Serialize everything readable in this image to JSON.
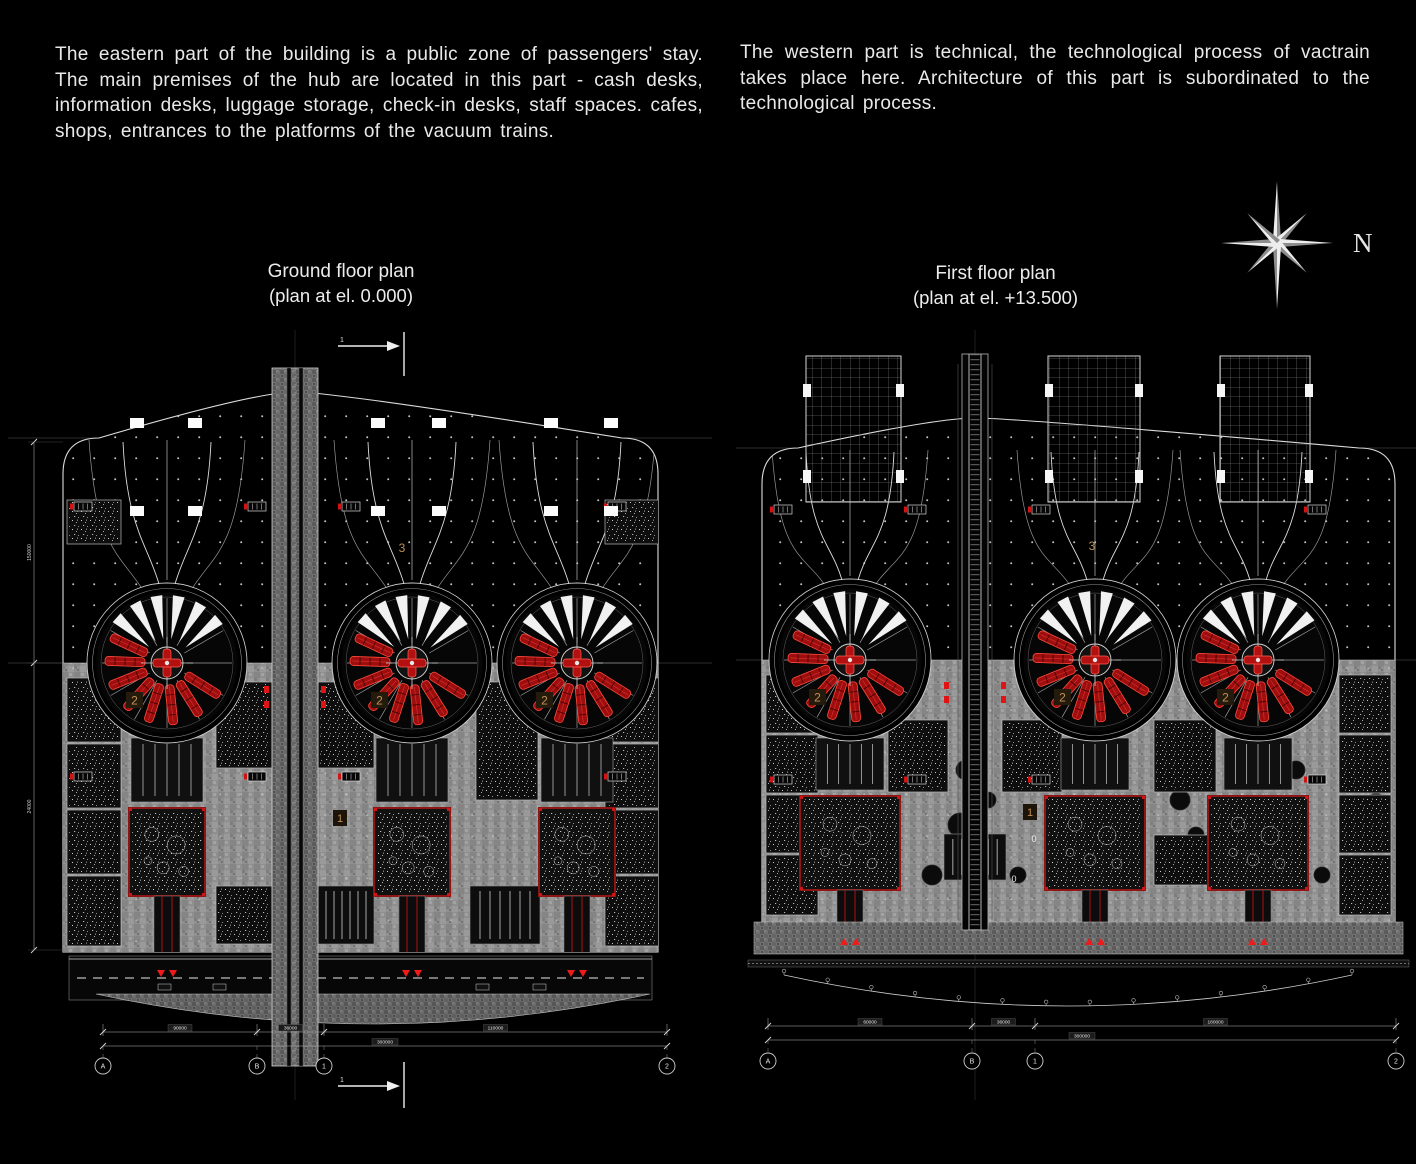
{
  "intro": {
    "left": "The eastern part of the building is a public zone of passengers' stay. The main premises of the hub are located in this part - cash desks, information desks, luggage storage, check-in desks, staff spaces. cafes, shops, entrances to the platforms of the vacuum trains.",
    "right": "The western part is technical, the technological process of vactrain takes place here. Architecture of this part is subordinated to the technological process."
  },
  "compass": {
    "label": "N"
  },
  "colors": {
    "background": "#000000",
    "linework": "#e0e0e0",
    "concourse_gray": "#8f8f8f",
    "platform_red": "#b31111",
    "accent_red": "#ff4a3c",
    "hall_outline_red": "#8f1414",
    "zone_label_tan": "#c09055"
  },
  "plans": [
    {
      "id": "p0",
      "title": "Ground floor plan",
      "subtitle": "(plan at el. 0.000)",
      "zone_labels": {
        "hall": "3",
        "platforms": "2",
        "concourse": "1"
      },
      "dims": {
        "segments": [
          "90000",
          "36000",
          "110000"
        ],
        "total": "300000"
      },
      "bubbles": [
        "A",
        "B",
        "1",
        "2"
      ],
      "side_dims": [
        "150000",
        "24000"
      ],
      "section_label": "1",
      "geometry": {
        "width": 704,
        "height": 800,
        "left": 55,
        "right": 650,
        "topSide": 108,
        "topCenter": 62,
        "grayTop": 333,
        "bottom": 622,
        "corridorX": 287,
        "corridorStyle": "hatched",
        "corridorTop": 38,
        "corridorBottom": 736,
        "fanY": 333,
        "fanR": 75,
        "fans": [
          159,
          404,
          569
        ],
        "topSquares": {
          "rows": [
            88,
            176
          ],
          "xs": [
            122,
            180,
            363,
            424,
            536,
            596
          ]
        },
        "rooms": [
          [
            59,
            170,
            54,
            44,
            "dark"
          ],
          [
            597,
            170,
            54,
            44,
            "dark"
          ],
          [
            59,
            348,
            54,
            64,
            "dark"
          ],
          [
            59,
            414,
            54,
            64,
            "dark"
          ],
          [
            59,
            480,
            54,
            64,
            "dark"
          ],
          [
            59,
            546,
            54,
            70,
            "dark"
          ],
          [
            597,
            348,
            54,
            64,
            "dark"
          ],
          [
            597,
            414,
            54,
            64,
            "dark"
          ],
          [
            597,
            480,
            54,
            64,
            "dark"
          ],
          [
            597,
            546,
            54,
            70,
            "dark"
          ],
          [
            208,
            352,
            56,
            86,
            "dark"
          ],
          [
            310,
            352,
            56,
            86,
            "dark"
          ],
          [
            208,
            556,
            56,
            58,
            "dark"
          ],
          [
            310,
            556,
            56,
            58,
            "lines"
          ],
          [
            468,
            352,
            62,
            118,
            "dark"
          ],
          [
            462,
            556,
            70,
            58,
            "lines"
          ],
          [
            123,
            408,
            72,
            64,
            "gate"
          ],
          [
            368,
            408,
            72,
            64,
            "gate"
          ],
          [
            533,
            408,
            72,
            64,
            "gate"
          ],
          [
            121,
            478,
            76,
            88,
            "red"
          ],
          [
            366,
            478,
            76,
            88,
            "red"
          ],
          [
            531,
            478,
            76,
            88,
            "red"
          ]
        ],
        "doorRows": {
          "ys": [
            172,
            442
          ],
          "xs": [
            66,
            240,
            334,
            600
          ]
        },
        "corridorReds": [
          356,
          371
        ],
        "road": {
          "y": 626,
          "h": 44
        },
        "apron": {
          "x1": 88,
          "x2": 642,
          "yTop": 664,
          "dip": 694
        },
        "dimTicks": [
          95,
          249,
          316,
          659
        ],
        "dimY": 702,
        "totalY": 716,
        "bubbleY": 736,
        "sideDim": {
          "x": 26,
          "y1": 112,
          "y2": 620,
          "mid": 333
        },
        "sectionMarker": true,
        "label3": [
          394,
          222
        ],
        "label1": [
          332,
          492
        ]
      }
    },
    {
      "id": "p1",
      "title": "First floor plan",
      "subtitle": "(plan at el. +13.500)",
      "zone_labels": {
        "hall": "3",
        "platforms": "2",
        "concourse": "1",
        "void": "0"
      },
      "dims": {
        "segments": [
          "60000",
          "36000",
          "180000"
        ],
        "total": "300000"
      },
      "bubbles": [
        "A",
        "B",
        "1",
        "2"
      ],
      "geometry": {
        "width": 680,
        "height": 800,
        "left": 26,
        "right": 659,
        "topSide": 118,
        "topCenter": 88,
        "grayTop": 330,
        "bottom": 592,
        "corridorX": 239,
        "corridorStyle": "rails",
        "corridorTop": 24,
        "corridorBottom": 600,
        "fanY": 330,
        "fanR": 76,
        "fans": [
          114,
          359,
          522
        ],
        "topGrids": {
          "cols": [
            [
              70,
              165
            ],
            [
              312,
              404
            ],
            [
              484,
              574
            ]
          ],
          "y1": 26,
          "y2": 172
        },
        "rooms": [
          [
            30,
            345,
            52,
            58,
            "dark"
          ],
          [
            30,
            405,
            52,
            58,
            "dark"
          ],
          [
            30,
            465,
            52,
            58,
            "dark"
          ],
          [
            30,
            525,
            52,
            60,
            "dark"
          ],
          [
            603,
            345,
            52,
            58,
            "dark"
          ],
          [
            603,
            405,
            52,
            58,
            "dark"
          ],
          [
            603,
            465,
            52,
            58,
            "dark"
          ],
          [
            603,
            525,
            52,
            60,
            "dark"
          ],
          [
            152,
            390,
            60,
            72,
            "dark"
          ],
          [
            266,
            390,
            60,
            72,
            "dark"
          ],
          [
            418,
            390,
            62,
            72,
            "dark"
          ],
          [
            208,
            504,
            62,
            46,
            "lines"
          ],
          [
            418,
            505,
            66,
            50,
            "dark"
          ],
          [
            80,
            408,
            68,
            52,
            "gate"
          ],
          [
            325,
            408,
            68,
            52,
            "gate"
          ],
          [
            488,
            408,
            68,
            52,
            "gate"
          ],
          [
            64,
            466,
            100,
            94,
            "red"
          ],
          [
            309,
            466,
            100,
            94,
            "red"
          ],
          [
            472,
            466,
            100,
            94,
            "red"
          ]
        ],
        "trees": [
          [
            230,
            440,
            10
          ],
          [
            252,
            470,
            8
          ],
          [
            224,
            495,
            12
          ],
          [
            444,
            470,
            10
          ],
          [
            460,
            505,
            8
          ],
          [
            430,
            545,
            9
          ],
          [
            196,
            545,
            10
          ],
          [
            282,
            545,
            8
          ],
          [
            560,
            440,
            9
          ],
          [
            586,
            545,
            8
          ],
          [
            640,
            470,
            7
          ],
          [
            350,
            445,
            7
          ]
        ],
        "doorRows": {
          "ys": [
            175,
            445
          ],
          "xs": [
            38,
            172,
            296,
            572
          ]
        },
        "corridorReds": [
          352,
          366
        ],
        "band": {
          "y": 592,
          "h": 32
        },
        "roadStrip": {
          "y": 630,
          "h": 7
        },
        "arc": {
          "x1": 48,
          "x2": 616,
          "y": 645,
          "dip": 676
        },
        "dimTicks": [
          32,
          236,
          299,
          660
        ],
        "dimY": 696,
        "totalY": 710,
        "bubbleY": 731,
        "label3": [
          356,
          220
        ],
        "label1": [
          294,
          486
        ],
        "zeros": [
          [
            298,
            512
          ],
          [
            278,
            552
          ]
        ]
      }
    }
  ]
}
